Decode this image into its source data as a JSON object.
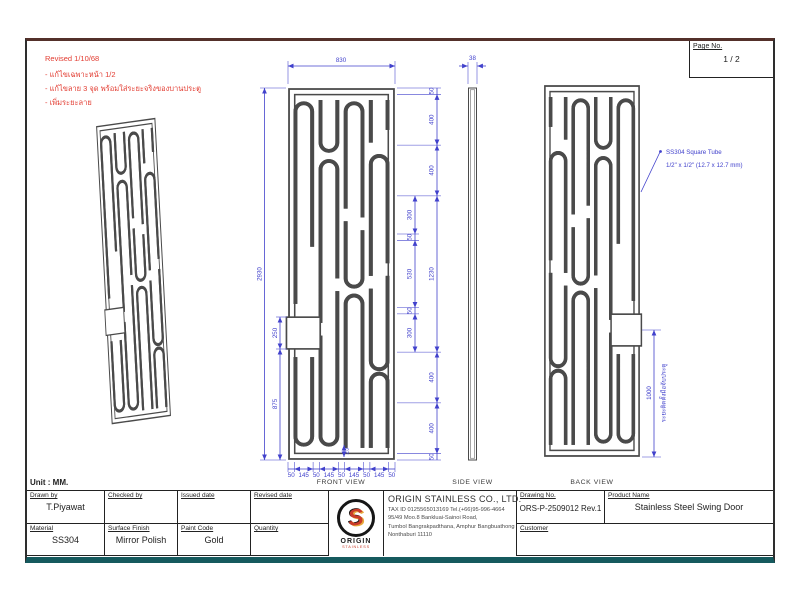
{
  "page": {
    "page_no_label": "Page No.",
    "page_no": "1 / 2",
    "unit_label": "Unit : MM."
  },
  "revision": {
    "title": "Revised 1/10/68",
    "notes": [
      "- แก้ไขเฉพาะหน้า 1/2",
      "- แก้ไขลาย 3 จุด พร้อมใส่ระยะจริงของบานประตู",
      "- เพิ่มระยะลาย"
    ]
  },
  "colors": {
    "dimension_blue": "#4141cc",
    "drawing_line": "#4a4a4a",
    "revision_red": "#e23b30",
    "logo_red": "#c93b2a",
    "logo_yellow": "#e7a93c"
  },
  "views": {
    "front_label": "FRONT VIEW",
    "side_label": "SIDE VIEW",
    "back_label": "BACK VIEW"
  },
  "dimensions": {
    "front_width": "830",
    "front_height": "2930",
    "side_thickness": "38",
    "right_chain": [
      "50",
      "400",
      "400",
      "1230",
      "400",
      "400",
      "50"
    ],
    "right_inner_chain": [
      "300",
      "50",
      "530",
      "50",
      "300"
    ],
    "left_notch": "250",
    "left_lower": "875",
    "bottom_chain": [
      "50",
      "145",
      "50",
      "145",
      "50",
      "145",
      "50",
      "145",
      "50"
    ],
    "tube_gap": "25",
    "handle_distance": "1000",
    "handle_note": "ระยะติดตั้งมือจับประตู"
  },
  "annotation": {
    "line1": "SS304 Square Tube",
    "line2": "1/2\" x 1/2\" (12.7 x 12.7 mm)"
  },
  "title_block": {
    "drawn_by": {
      "label": "Drawn by",
      "value": "T.Piyawat"
    },
    "checked_by": {
      "label": "Checked by",
      "value": ""
    },
    "issued_date": {
      "label": "Issued date",
      "value": ""
    },
    "revised_date": {
      "label": "Revised date",
      "value": ""
    },
    "material": {
      "label": "Material",
      "value": "SS304"
    },
    "surface_finish": {
      "label": "Surface Finish",
      "value": "Mirror Polish"
    },
    "paint_code": {
      "label": "Paint Code",
      "value": "Gold"
    },
    "quantity": {
      "label": "Quantity",
      "value": ""
    },
    "drawing_no": {
      "label": "Drawing No.",
      "value": "ORS-P-2509012 Rev.1"
    },
    "product_name": {
      "label": "Product Name",
      "value": "Stainless Steel Swing Door"
    },
    "customer": {
      "label": "Customer",
      "value": ""
    },
    "company": {
      "name": "ORIGIN STAINLESS CO., LTD.",
      "tax_line": "TAX ID 0125565013169  Tel.(+66)95-996-4664",
      "address1": "95/49 Moo.8 Bankluai-Sainoi Road,",
      "address2": "Tumbol Bangrakpadthana, Amphur Bangbuathong",
      "address3": "Nonthaburi 11110",
      "logo_text": "ORIGIN",
      "logo_sub": "STAINLESS"
    }
  }
}
